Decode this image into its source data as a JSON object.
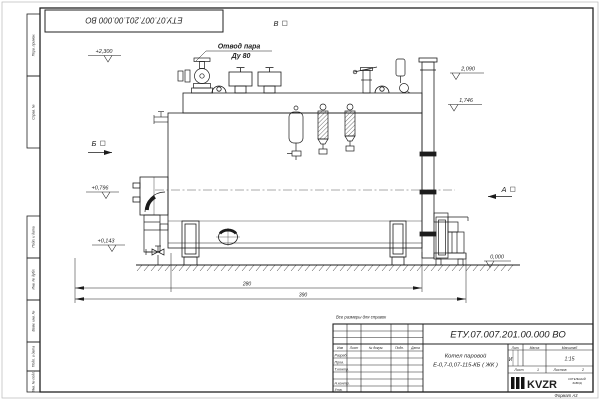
{
  "frame": {
    "top_stamp_number": "ЕТУ.07.007.201.00.000  ВО",
    "side_cells": [
      "Перв. примен.",
      "Справ. №",
      "Подп. и дата",
      "Инв. № дубл.",
      "Взам. инв. №",
      "Подп. и дата",
      "Инв. № подл."
    ],
    "format_label": "Формат А3"
  },
  "drawing": {
    "callout": {
      "line1": "Отвод пара",
      "line2": "Ду 80"
    },
    "views": {
      "v": "В",
      "b": "Б",
      "a": "А"
    },
    "elevations": {
      "e1": "+2,300",
      "e2": "2,090",
      "e3": "1,746",
      "e4": "+0,796",
      "e5": "+0,143",
      "e6": "0,000"
    },
    "dimensions": {
      "d1": "280",
      "d2": "390"
    }
  },
  "note": "Все размеры для справок",
  "title_block": {
    "doc_number": "ЕТУ.07.007.201.00.000  ВО",
    "product_line1": "Котел паровой",
    "product_line2": "Е-0,7-0,07-115-КБ ( ЖК )",
    "col_izm": "Изм",
    "col_list": "Лист",
    "col_ndok": "№ докум.",
    "col_podp": "Подп.",
    "col_data": "Дата",
    "row_razrab": "Разраб.",
    "row_prov": "Пров.",
    "row_tkontr": "Т.контр.",
    "row_nkontr": "Н.контр.",
    "row_utv": "Утв.",
    "lit_header": "Лит.",
    "mass_header": "Масса",
    "scale_header": "Масштаб",
    "lit_value": "И",
    "scale_value": "1:15",
    "sheet_label": "Лист",
    "sheet_value": "1",
    "sheets_label": "Листов",
    "sheets_value": "2",
    "logo_text": "KVZR",
    "logo_sub1": "КОТЕЛЬНЫЙ",
    "logo_sub2": "ЗАВОД"
  }
}
